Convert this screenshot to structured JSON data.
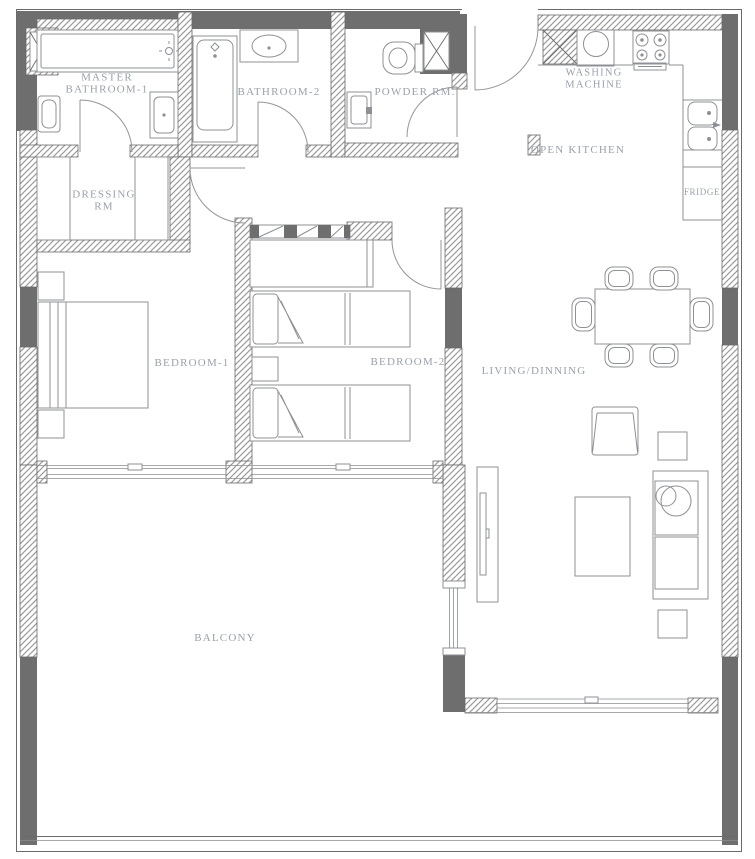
{
  "plan": {
    "title": "Apartment floor plan",
    "rooms": {
      "master_bathroom": {
        "line1": "MASTER",
        "line2": "BATHROOM-1"
      },
      "dressing_room": {
        "line1": "DRESSING",
        "line2": "RM"
      },
      "bathroom_2": {
        "label": "BATHROOM-2"
      },
      "powder_room": {
        "label": "POWDER RM."
      },
      "washing_machine": {
        "line1": "WASHING",
        "line2": "MACHINE"
      },
      "open_kitchen": {
        "label": "OPEN KITCHEN"
      },
      "fridge": {
        "label": "FRIDGE"
      },
      "bedroom_1": {
        "label": "BEDROOM-1"
      },
      "bedroom_2": {
        "label": "BEDROOM-2"
      },
      "living_dining": {
        "label": "LIVING/DINNING"
      },
      "balcony": {
        "label": "BALCONY"
      }
    },
    "colors": {
      "background": "#ffffff",
      "wall_solid": "#6e6e6e",
      "wall_hatch_line": "#9b9b9b",
      "wall_stroke": "#6a6a6a",
      "line": "#8d9096",
      "label": "#9aa1ab"
    }
  }
}
